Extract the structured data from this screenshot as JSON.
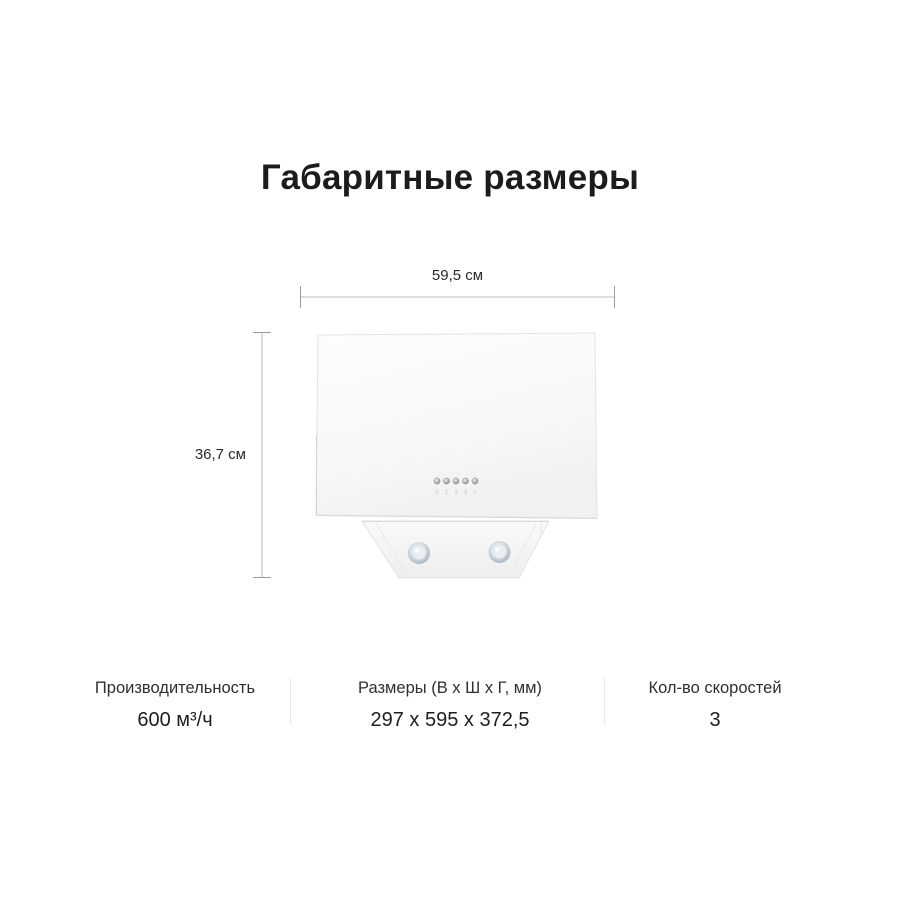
{
  "page": {
    "title": "Габаритные размеры"
  },
  "diagram": {
    "width_label": "59,5 см",
    "height_label": "36,7 см",
    "product": {
      "kind": "kitchen-hood",
      "control_labels": [
        "0",
        "1",
        "2",
        "3",
        "☼"
      ],
      "lights_count": 2
    }
  },
  "specs": {
    "columns": [
      {
        "label": "Производительность",
        "value": "600 м³/ч"
      },
      {
        "label": "Размеры (В х Ш х Г, мм)",
        "value": "297 x 595 x 372,5"
      },
      {
        "label": "Кол-во скоростей",
        "value": "3"
      }
    ]
  },
  "colors": {
    "background": "#ffffff",
    "text_primary": "#1c1c1c",
    "dimension_line": "#b8b8b8",
    "divider": "#e8e8e8"
  }
}
